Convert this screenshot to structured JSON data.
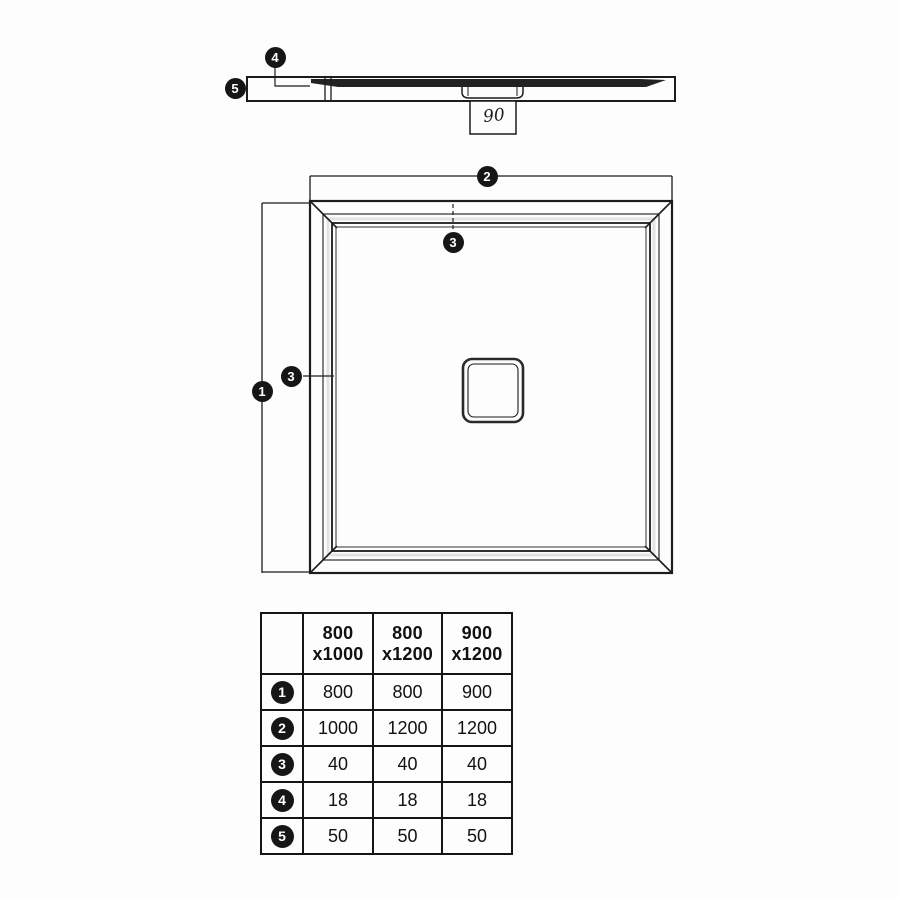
{
  "colors": {
    "ink": "#1c1c1c",
    "paper": "#fdfdfd"
  },
  "markers": {
    "m1": "1",
    "m2": "2",
    "m3": "3",
    "m4": "4",
    "m5": "5"
  },
  "side_view": {
    "drain_dimension": "90"
  },
  "table": {
    "columns": [
      {
        "line1": "800",
        "line2": "x1000"
      },
      {
        "line1": "800",
        "line2": "x1200"
      },
      {
        "line1": "900",
        "line2": "x1200"
      }
    ],
    "rows": [
      {
        "marker": "1",
        "values": [
          "800",
          "800",
          "900"
        ]
      },
      {
        "marker": "2",
        "values": [
          "1000",
          "1200",
          "1200"
        ]
      },
      {
        "marker": "3",
        "values": [
          "40",
          "40",
          "40"
        ]
      },
      {
        "marker": "4",
        "values": [
          "18",
          "18",
          "18"
        ]
      },
      {
        "marker": "5",
        "values": [
          "50",
          "50",
          "50"
        ]
      }
    ]
  }
}
